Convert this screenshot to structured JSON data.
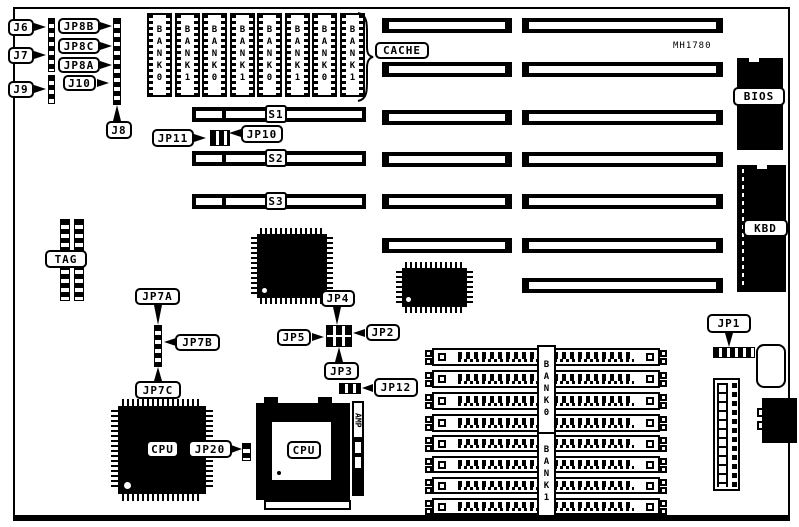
{
  "board": {
    "model": "MH1780"
  },
  "labels": {
    "j6": "J6",
    "j7": "J7",
    "j9": "J9",
    "jp8b": "JP8B",
    "jp8c": "JP8C",
    "jp8a": "JP8A",
    "j10": "J10",
    "j8": "J8",
    "cache": "CACHE",
    "jp11": "JP11",
    "jp10": "JP10",
    "tag": "TAG",
    "jp7a": "JP7A",
    "jp7b": "JP7B",
    "jp7c": "JP7C",
    "jp4": "JP4",
    "jp5": "JP5",
    "jp2": "JP2",
    "jp3": "JP3",
    "jp12": "JP12",
    "jp20": "JP20",
    "jp1": "JP1",
    "bios": "BIOS",
    "kbd": "KBD",
    "amp": "AMP",
    "cpu_qfp": "CPU",
    "cpu_socket": "CPU"
  },
  "slots": {
    "s1": "S1",
    "s2": "S2",
    "s3": "S3"
  },
  "memory": {
    "top_simms": [
      "BANK0",
      "BANK1",
      "BANK0",
      "BANK1",
      "BANK0",
      "BANK1",
      "BANK0",
      "BANK1"
    ],
    "bottom_banks": [
      "BANK0",
      "BANK1"
    ]
  },
  "colors": {
    "ink": "#000000",
    "paper": "#ffffff"
  }
}
